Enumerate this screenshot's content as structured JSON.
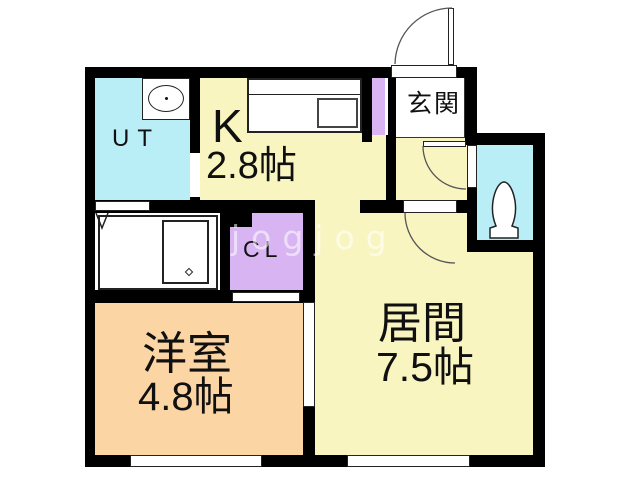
{
  "plan": {
    "title": "apartment-floor-plan",
    "watermark": "jogjog",
    "rooms": {
      "ut": {
        "label": "UT"
      },
      "kitchen": {
        "label": "K",
        "size": "2.8帖"
      },
      "entrance": {
        "label": "玄関"
      },
      "closet": {
        "label": "CL"
      },
      "western": {
        "label": "洋室",
        "size": "4.8帖"
      },
      "living": {
        "label": "居間",
        "size": "7.5帖"
      }
    },
    "colors": {
      "room_yellow": "#f8f5c1",
      "room_cyan": "#b9eef7",
      "closet_lavender": "#d8b5f2",
      "room_peach": "#fbd5a3",
      "wall_black": "#000000",
      "line_dark": "#222222"
    },
    "fixtures": {
      "washbasin": "washbasin",
      "kitchen_counter": "kitchen-counter-with-sink",
      "bathtub": "bathtub",
      "toilet": "toilet",
      "doors": "swing-door-arcs"
    }
  }
}
